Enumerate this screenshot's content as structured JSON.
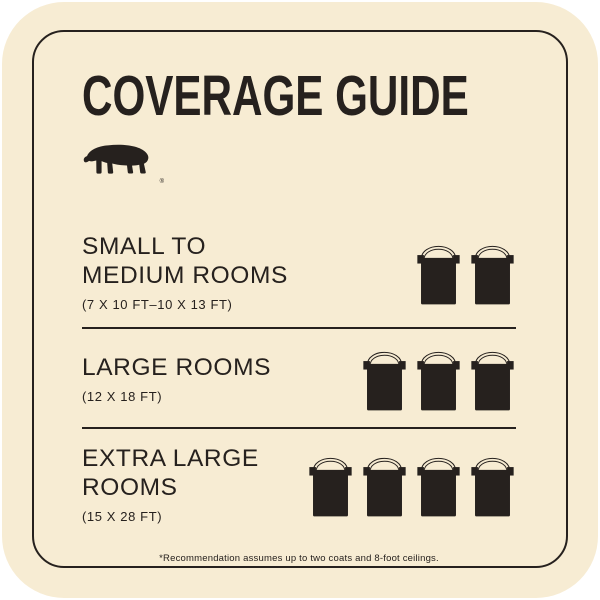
{
  "card": {
    "background_color": "#F7ECD3",
    "ink_color": "#26211E",
    "handle_color": "#8C8170",
    "title": "COVERAGE GUIDE",
    "logo": "behr-bear-logo",
    "registered_mark": "®",
    "rows": [
      {
        "line1": "SMALL TO",
        "line2": "MEDIUM ROOMS",
        "dimensions": "(7 X 10 FT–10 X 13 FT)",
        "can_count": 2
      },
      {
        "line1": "LARGE ROOMS",
        "line2": "",
        "dimensions": "(12 X 18 FT)",
        "can_count": 3
      },
      {
        "line1": "EXTRA LARGE",
        "line2": "ROOMS",
        "dimensions": "(15 X 28 FT)",
        "can_count": 4
      }
    ],
    "footnote": "*Recommendation assumes up to two coats and 8-foot ceilings.",
    "can_icon": "paint-can-icon"
  }
}
